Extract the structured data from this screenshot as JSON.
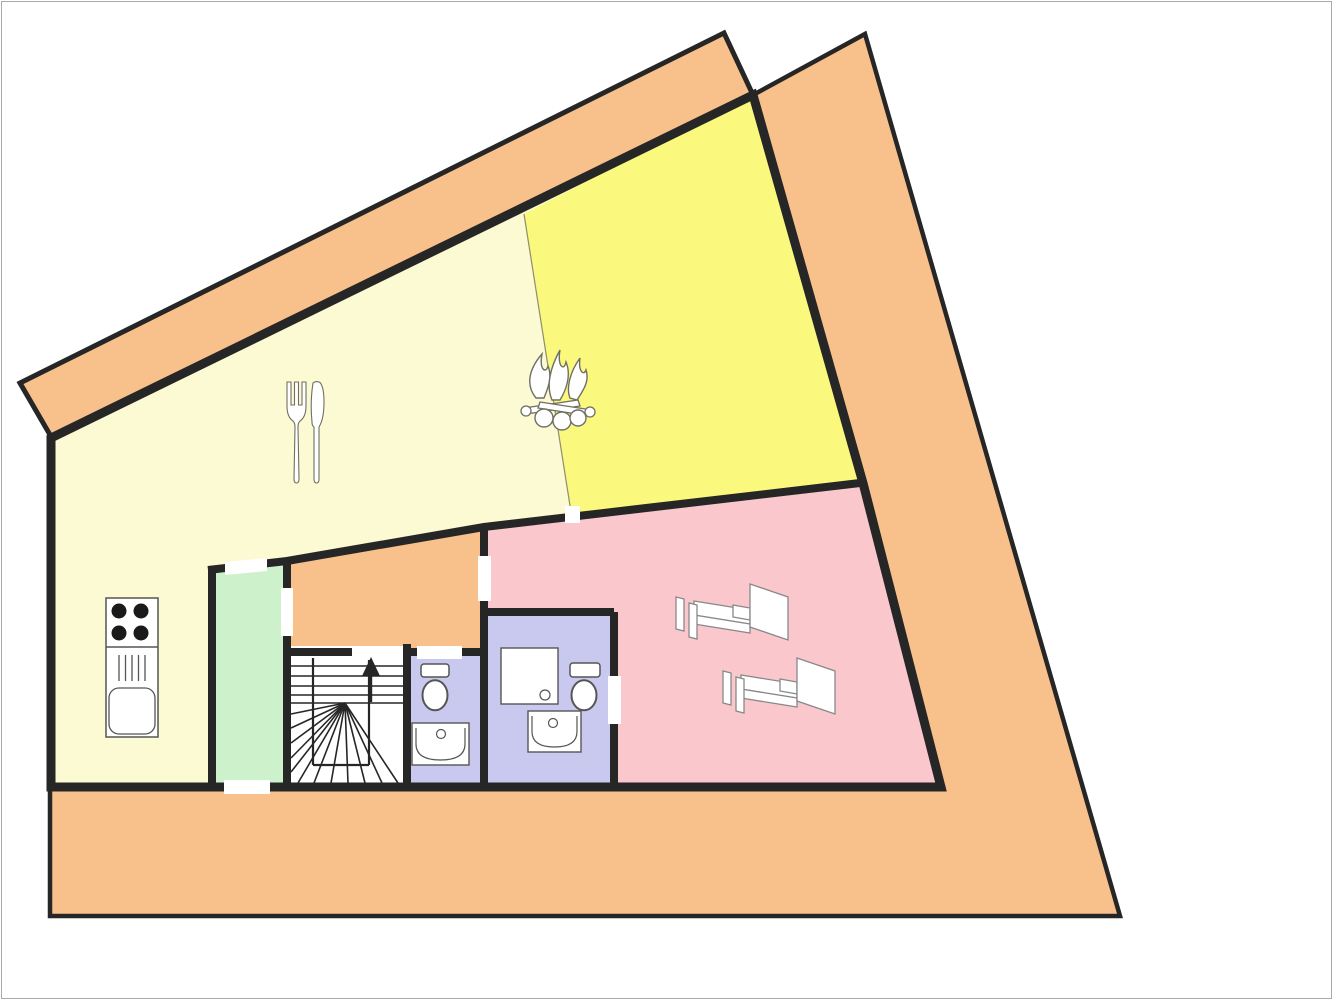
{
  "canvas": {
    "width": 1333,
    "height": 1000,
    "background": "#ffffff",
    "frame_color": "#aaaaaa"
  },
  "palette": {
    "wall": "#262626",
    "terrace": "#F8C18C",
    "pale_yellow": "#FCFAD2",
    "bright_yellow": "#FAF87D",
    "pink": "#F9C7CC",
    "green": "#CDF2CB",
    "lavender": "#C9C9EF",
    "white": "#ffffff",
    "fixture_stroke": "#555555",
    "bed_stroke": "#888888",
    "icon_stroke": "#6f6f66",
    "divider": "#8E8E6E"
  },
  "rooms": [
    {
      "name": "terrace",
      "fill": "terrace",
      "outlined": true,
      "stroke_width": 4.5,
      "points": [
        [
          865,
          34
        ],
        [
          1120,
          916
        ],
        [
          50,
          916
        ],
        [
          50,
          438
        ],
        [
          753,
          95
        ]
      ]
    },
    {
      "name": "balcony-band",
      "fill": "terrace",
      "outlined": true,
      "stroke_width": 5,
      "points": [
        [
          20,
          383
        ],
        [
          724,
          33
        ],
        [
          753,
          95
        ],
        [
          53,
          440
        ]
      ]
    },
    {
      "name": "dining-room",
      "fill": "pale_yellow",
      "points": [
        [
          51,
          440
        ],
        [
          753,
          95
        ],
        [
          863,
          483
        ],
        [
          941,
          786
        ],
        [
          51,
          786
        ]
      ]
    },
    {
      "name": "living-room",
      "fill": "bright_yellow",
      "points": [
        [
          524,
          214
        ],
        [
          753,
          95
        ],
        [
          863,
          483
        ],
        [
          571,
          514
        ]
      ]
    },
    {
      "name": "bedroom",
      "fill": "pink",
      "points": [
        [
          484,
          528
        ],
        [
          860,
          483
        ],
        [
          941,
          786
        ],
        [
          614,
          786
        ],
        [
          614,
          612
        ],
        [
          484,
          612
        ]
      ]
    },
    {
      "name": "hallway",
      "fill": "terrace",
      "points": [
        [
          287,
          561
        ],
        [
          484,
          527
        ],
        [
          484,
          652
        ],
        [
          287,
          652
        ]
      ]
    },
    {
      "name": "storage-room",
      "fill": "green",
      "points": [
        [
          212,
          569
        ],
        [
          287,
          561
        ],
        [
          287,
          786
        ],
        [
          212,
          786
        ]
      ]
    },
    {
      "name": "stair-chamber",
      "fill": "white",
      "points": [
        [
          287,
          646
        ],
        [
          407,
          646
        ],
        [
          407,
          786
        ],
        [
          287,
          786
        ]
      ]
    },
    {
      "name": "bathroom-1",
      "fill": "lavender",
      "points": [
        [
          407,
          652
        ],
        [
          484,
          652
        ],
        [
          484,
          786
        ],
        [
          407,
          786
        ]
      ]
    },
    {
      "name": "bathroom-2",
      "fill": "lavender",
      "points": [
        [
          484,
          612
        ],
        [
          614,
          612
        ],
        [
          614,
          786
        ],
        [
          484,
          786
        ]
      ]
    }
  ],
  "divider": {
    "points": [
      [
        524,
        214
      ],
      [
        571,
        512
      ]
    ],
    "width": 1.2
  },
  "walls": [
    {
      "name": "envelope",
      "width": 9,
      "closed": true,
      "points": [
        [
          51,
          438
        ],
        [
          753,
          95
        ],
        [
          863,
          483
        ],
        [
          941,
          787
        ],
        [
          51,
          787
        ]
      ]
    },
    {
      "name": "partition-main",
      "width": 8,
      "points": [
        [
          208,
          570
        ],
        [
          287,
          561
        ],
        [
          484,
          527
        ],
        [
          860,
          483
        ]
      ]
    },
    {
      "name": "storage-left",
      "width": 8,
      "points": [
        [
          212,
          567
        ],
        [
          212,
          787
        ]
      ]
    },
    {
      "name": "storage-right",
      "width": 8,
      "points": [
        [
          287,
          559
        ],
        [
          287,
          787
        ]
      ]
    },
    {
      "name": "bedroom-left",
      "width": 8,
      "points": [
        [
          484,
          527
        ],
        [
          484,
          787
        ]
      ]
    },
    {
      "name": "stairs-top",
      "width": 8,
      "points": [
        [
          283,
          652
        ],
        [
          352,
          652
        ]
      ]
    },
    {
      "name": "stairs-right",
      "width": 8,
      "points": [
        [
          407,
          644
        ],
        [
          407,
          787
        ]
      ]
    },
    {
      "name": "bath1-top",
      "width": 8,
      "points": [
        [
          407,
          652
        ],
        [
          484,
          652
        ]
      ]
    },
    {
      "name": "bath2-top",
      "width": 8,
      "points": [
        [
          484,
          612
        ],
        [
          614,
          612
        ]
      ]
    },
    {
      "name": "bath2-right",
      "width": 8,
      "points": [
        [
          614,
          612
        ],
        [
          614,
          787
        ]
      ]
    }
  ],
  "door_gaps": [
    {
      "name": "storage-top-door",
      "points": [
        [
          225,
          562
        ],
        [
          267,
          558
        ],
        [
          267,
          571
        ],
        [
          225,
          575
        ]
      ]
    },
    {
      "name": "storage-hallway-door",
      "points": [
        [
          281,
          588
        ],
        [
          293,
          588
        ],
        [
          293,
          636
        ],
        [
          281,
          636
        ]
      ]
    },
    {
      "name": "storage-terrace-door",
      "points": [
        [
          224,
          780
        ],
        [
          270,
          780
        ],
        [
          270,
          794
        ],
        [
          224,
          794
        ]
      ]
    },
    {
      "name": "hallway-bedroom-door",
      "points": [
        [
          478,
          556
        ],
        [
          491,
          556
        ],
        [
          491,
          601
        ],
        [
          478,
          601
        ]
      ]
    },
    {
      "name": "stairs-entry-gap",
      "points": [
        [
          352,
          646
        ],
        [
          403,
          646
        ],
        [
          403,
          659
        ],
        [
          352,
          659
        ]
      ]
    },
    {
      "name": "bathroom1-door",
      "points": [
        [
          417,
          646
        ],
        [
          462,
          646
        ],
        [
          462,
          659
        ],
        [
          417,
          659
        ]
      ]
    },
    {
      "name": "bathroom2-door",
      "points": [
        [
          608,
          676
        ],
        [
          621,
          676
        ],
        [
          621,
          724
        ],
        [
          608,
          724
        ]
      ]
    },
    {
      "name": "living-bedroom-door",
      "points": [
        [
          565,
          506
        ],
        [
          580,
          506
        ],
        [
          580,
          523
        ],
        [
          565,
          523
        ]
      ]
    }
  ],
  "staircase": {
    "tread_y": [
      666,
      676,
      686,
      695,
      703
    ],
    "tread_x": [
      291,
      403
    ],
    "stringers": [
      [
        [
          313,
          658
        ],
        [
          313,
          765
        ]
      ],
      [
        [
          369,
          660
        ],
        [
          369,
          765
        ]
      ],
      [
        [
          313,
          765
        ],
        [
          369,
          765
        ]
      ]
    ],
    "fan_center": [
      345,
      703
    ],
    "fan_ends": [
      [
        291,
        714
      ],
      [
        291,
        728
      ],
      [
        291,
        743
      ],
      [
        291,
        758
      ],
      [
        291,
        772
      ],
      [
        298,
        783
      ],
      [
        314,
        783
      ],
      [
        331,
        783
      ],
      [
        348,
        783
      ],
      [
        365,
        783
      ],
      [
        382,
        783
      ],
      [
        398,
        783
      ]
    ],
    "arrow": {
      "tip": [
        371,
        657
      ],
      "left": [
        362,
        676
      ],
      "right": [
        380,
        676
      ],
      "stem_bottom": [
        371,
        702
      ]
    }
  },
  "kitchen": {
    "x": 106,
    "y": 598,
    "w": 52,
    "h": 139,
    "divider_y": 647,
    "burner_r": 7.5,
    "burners": [
      [
        119,
        611
      ],
      [
        141,
        611
      ],
      [
        119,
        633
      ],
      [
        141,
        633
      ]
    ],
    "drain": {
      "x0": 119,
      "x1": 145,
      "lines": 5,
      "y0": 655,
      "y1": 681
    },
    "sink": {
      "x": 109,
      "y": 688,
      "w": 46,
      "h": 46,
      "r": 10
    }
  },
  "bathroom1": {
    "toilet": {
      "tank": [
        421,
        664,
        28,
        13
      ],
      "bowl": [
        435,
        690,
        12.5,
        15
      ]
    },
    "sink": {
      "x": 412,
      "y": 723,
      "w": 57,
      "h": 42,
      "faucet": [
        441,
        734
      ]
    }
  },
  "bathroom2": {
    "shower": {
      "x": 501,
      "y": 648,
      "w": 57,
      "h": 56,
      "drain": [
        545,
        695
      ]
    },
    "toilet": {
      "tank": [
        570,
        663,
        30,
        14
      ],
      "bowl": [
        584,
        690,
        12.5,
        15
      ]
    },
    "sink": {
      "x": 528,
      "y": 711,
      "w": 53,
      "h": 41,
      "faucet": [
        553,
        723
      ]
    }
  },
  "beds": [
    [
      676,
      584
    ],
    [
      723,
      658
    ]
  ],
  "icons": {
    "cutlery": {
      "x": 287,
      "y": 382
    },
    "campfire": {
      "x": 520,
      "y": 348
    }
  }
}
